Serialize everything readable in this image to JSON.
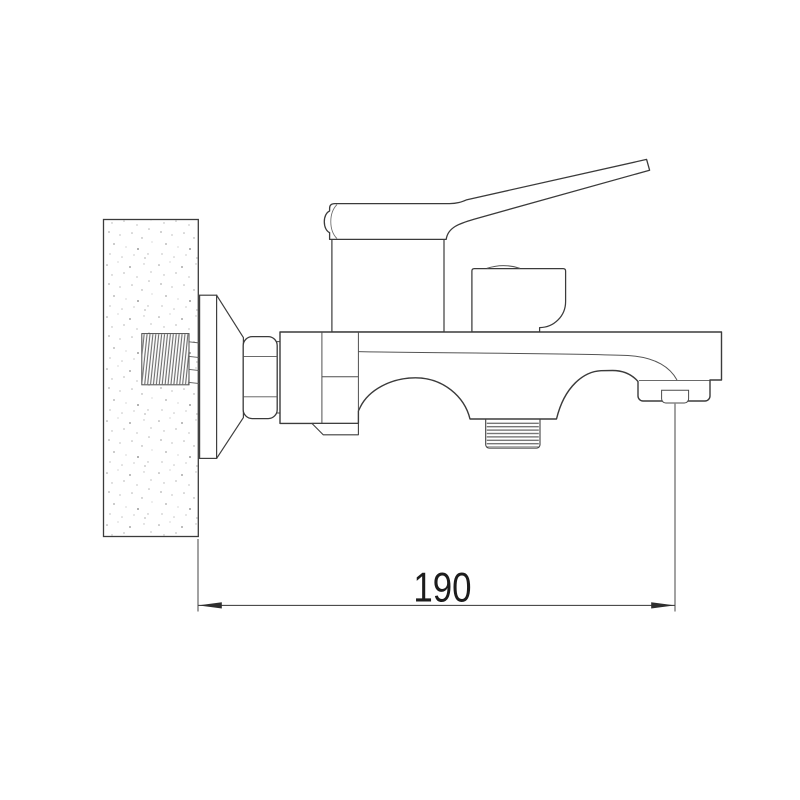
{
  "canvas": {
    "width": 800,
    "height": 800,
    "background": "#ffffff",
    "line_color": "#3b3b3b",
    "thread_line_color": "#6e6e6e",
    "wall_speckle_color": "#a9a9a9"
  },
  "dimension": {
    "value": "190"
  },
  "parts": [
    "wall-section",
    "wall-anchor-thread",
    "escutcheon-flange",
    "mounting-cone",
    "hex-nut",
    "nut-body-connector",
    "cartridge-column",
    "lever-handle",
    "diverter-knob",
    "mixer-body-and-spout",
    "mounting-foot",
    "shower-outlet-thread",
    "aerator",
    "dimension-line-190"
  ]
}
